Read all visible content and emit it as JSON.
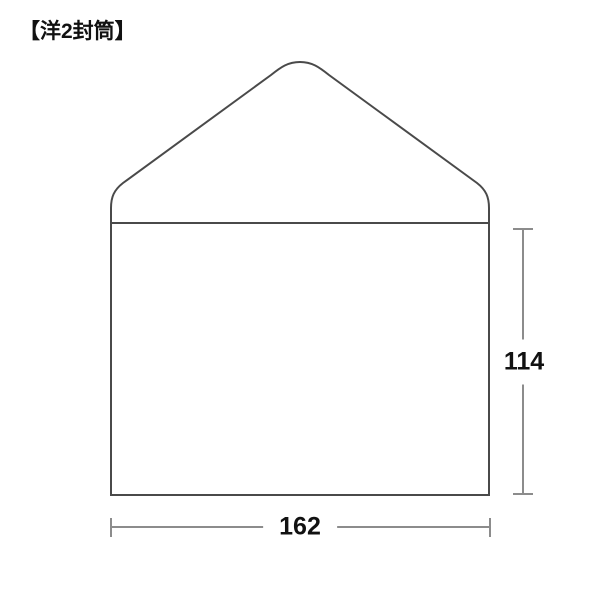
{
  "title": "【洋2封筒】",
  "diagram": {
    "type": "envelope-size-diagram",
    "envelope_name": "洋2封筒",
    "width_mm": "162",
    "height_mm": "114"
  },
  "colors": {
    "outline": "#4a4a4a",
    "dimension_line": "#8c8c8c",
    "text": "#111111",
    "background": "#ffffff"
  }
}
